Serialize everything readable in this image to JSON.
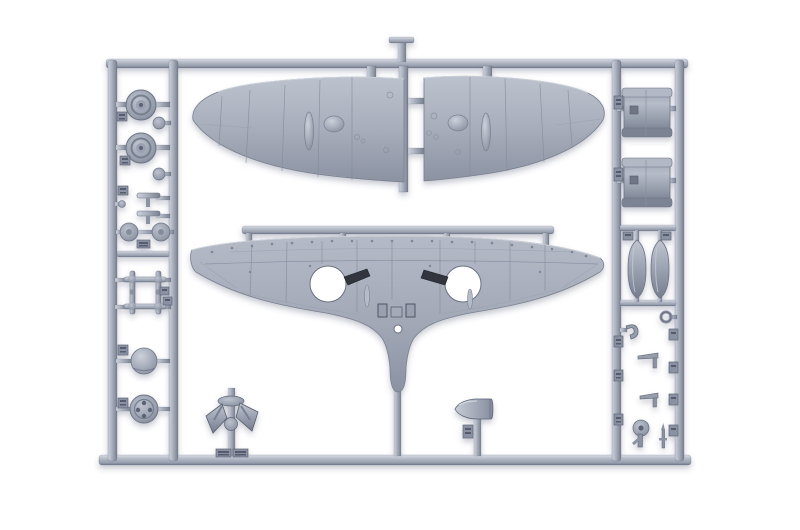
{
  "scene": {
    "type": "product-photo",
    "subject": "injection-molded plastic model kit sprue (parts frame) for an aircraft model, light grey styrene on white background",
    "background": "#ffffff"
  },
  "palette": {
    "plastic_light": "#d6dae2",
    "plastic_mid": "#a9afbc",
    "plastic_dark": "#7d8495",
    "plastic_deep": "#5f6678",
    "slot_dark": "#30343e",
    "background": "#ffffff",
    "shadow": "rgba(60,70,100,0.28)"
  },
  "parts": [
    {
      "id": "sprue-frame",
      "label": "rectangular runner frame with side columns",
      "count": 1
    },
    {
      "id": "upper-wing-half-left",
      "label": "upper wing half, left, with blister fairings",
      "count": 1
    },
    {
      "id": "upper-wing-half-right",
      "label": "upper wing half, right, with blister fairings",
      "count": 1
    },
    {
      "id": "lower-wing-one-piece",
      "label": "one-piece lower wing with two round wheel-well openings, dark cannon slots and centre belly fairing",
      "count": 1
    },
    {
      "id": "main-wheel",
      "label": "main landing-gear wheel",
      "count": 2
    },
    {
      "id": "hub-disc-pair",
      "label": "pair of small round hub discs",
      "count": 1
    },
    {
      "id": "axle-small-parts",
      "label": "small T-shaped axle parts",
      "count": 2
    },
    {
      "id": "landing-gear-struts",
      "label": "ladder-shaped landing gear strut assembly",
      "count": 1
    },
    {
      "id": "spinner-backplate-dome",
      "label": "domed backplate part",
      "count": 1
    },
    {
      "id": "wheel-hub-disc",
      "label": "disc with four holes",
      "count": 1
    },
    {
      "id": "radiator-drum",
      "label": "drum-shaped radiator housing",
      "count": 2
    },
    {
      "id": "teardrop-fairing",
      "label": "teardrop-shaped fairing half",
      "count": 2
    },
    {
      "id": "small-ring",
      "label": "small ring part",
      "count": 1
    },
    {
      "id": "small-hook",
      "label": "small hooked bracket",
      "count": 1
    },
    {
      "id": "lever-part",
      "label": "small T-lever part",
      "count": 2
    },
    {
      "id": "tail-wheel",
      "label": "tail wheel with fork",
      "count": 1
    },
    {
      "id": "pitot-tube",
      "label": "thin pitot/mast part",
      "count": 1
    },
    {
      "id": "propeller-blades-assembly",
      "label": "propeller blade pair on hub column",
      "count": 1
    },
    {
      "id": "propeller-spinner",
      "label": "bullet-shaped propeller spinner",
      "count": 1
    },
    {
      "id": "part-number-tag",
      "label": "embossed part-number tab on runner (numerals not legible)",
      "count": 18
    }
  ]
}
